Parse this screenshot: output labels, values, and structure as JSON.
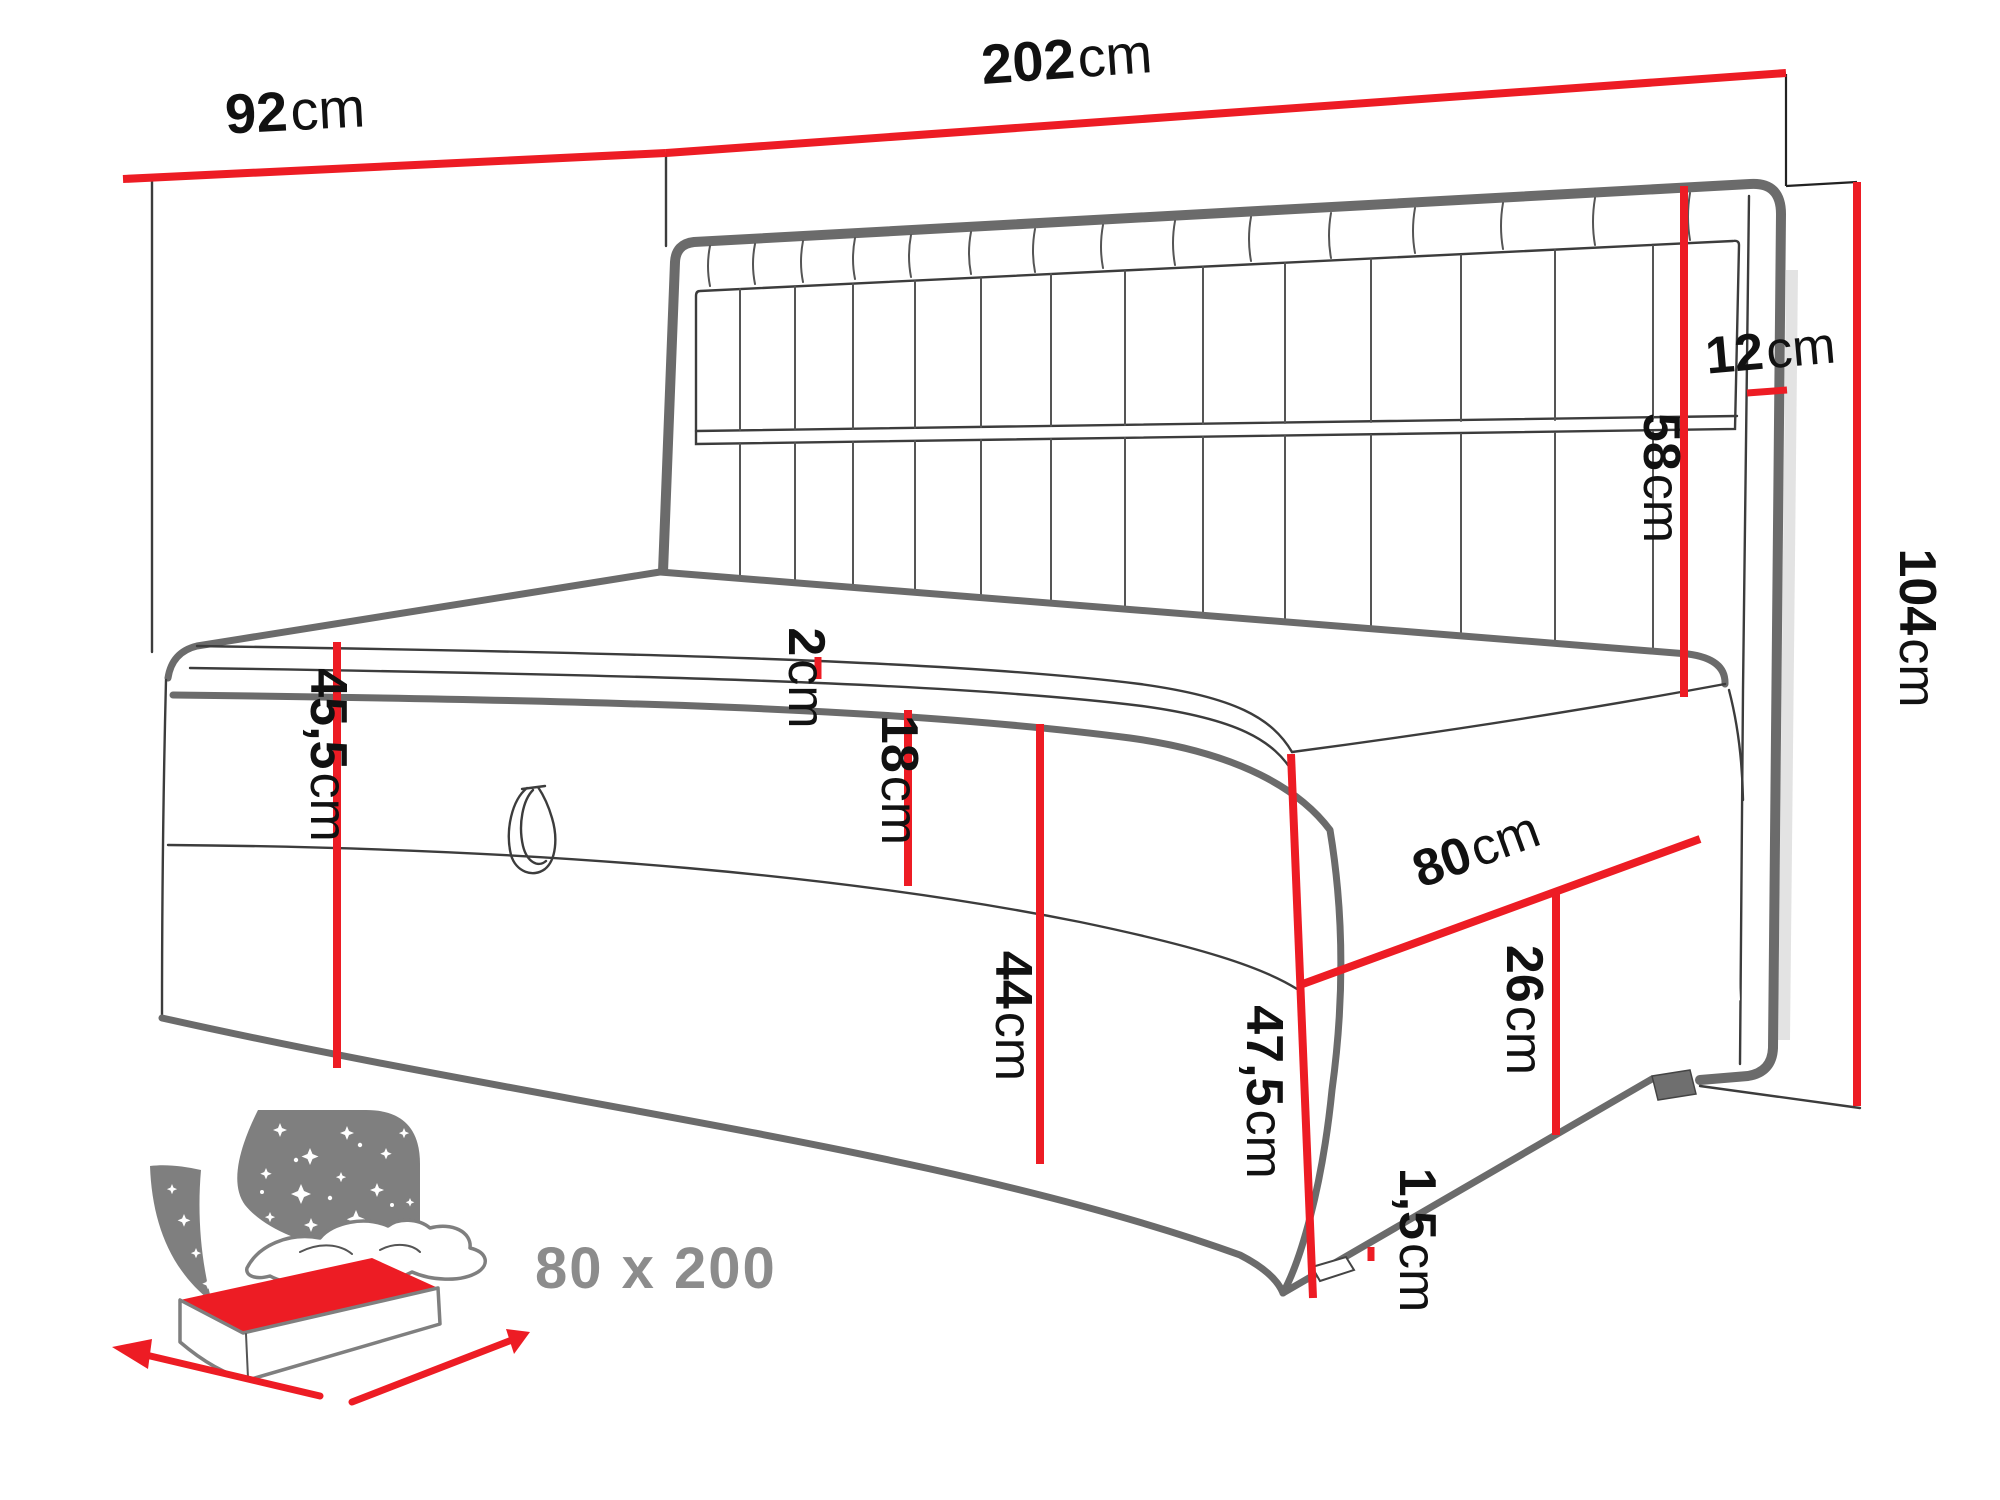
{
  "diagram": {
    "dimensions": {
      "side_panel_width": {
        "value": "92",
        "unit": "cm"
      },
      "back_panel_width": {
        "value": "202",
        "unit": "cm"
      },
      "panel_thickness": {
        "value": "12",
        "unit": "cm"
      },
      "headboard_height": {
        "value": "58",
        "unit": "cm"
      },
      "total_height": {
        "value": "104",
        "unit": "cm"
      },
      "seat_height": {
        "value": "45,5",
        "unit": "cm"
      },
      "topper_height": {
        "value": "2",
        "unit": "cm"
      },
      "mattress_height": {
        "value": "18",
        "unit": "cm"
      },
      "base_front_height": {
        "value": "44",
        "unit": "cm"
      },
      "bed_depth": {
        "value": "80",
        "unit": "cm"
      },
      "side_box_height": {
        "value": "26",
        "unit": "cm"
      },
      "box_total_height": {
        "value": "47,5",
        "unit": "cm"
      },
      "leg_height": {
        "value": "1,5",
        "unit": "cm"
      }
    },
    "badge": {
      "size_label": "80 x 200"
    },
    "colors": {
      "dimension_red": "#ed1c24",
      "outline_gray": "#6b6b6b",
      "thin_line": "#3c3c3c",
      "badge_gray": "#7f7f7f",
      "badge_text_gray": "#8c8c8c",
      "label_black": "#111111"
    }
  }
}
